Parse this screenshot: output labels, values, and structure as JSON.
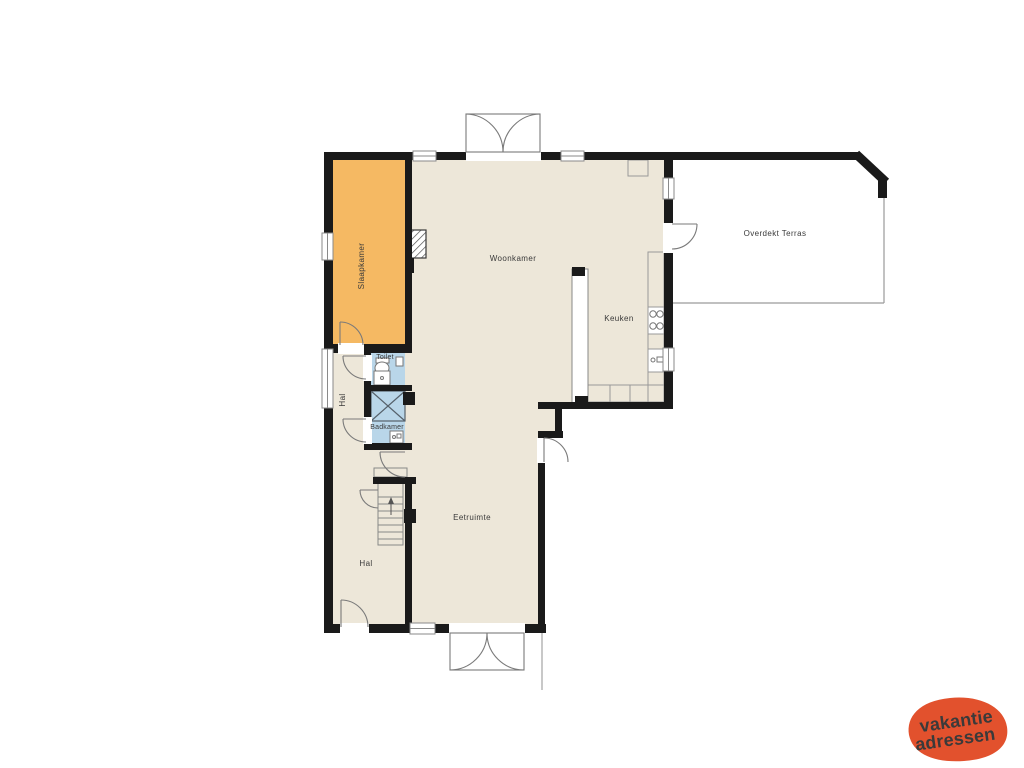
{
  "floorplan": {
    "labels": {
      "slaapkamer": "Slaapkamer",
      "woonkamer": "Woonkamer",
      "keuken": "Keuken",
      "toilet": "Toilet",
      "badkamer": "Badkamer",
      "hal_boven": "Hal",
      "hal_beneden": "Hal",
      "eetruimte": "Eetruimte",
      "terras": "Overdekt Terras"
    },
    "colors": {
      "wall": "#1a1a1a",
      "floor": "#ede7d9",
      "slaapkamer": "#f5b963",
      "sanitair": "#b9d6e9",
      "line": "#7a7a7a",
      "label": "#3a3a3a"
    }
  },
  "logo": {
    "line1": "vakantie",
    "line2": "adressen",
    "bg": "#e2512d",
    "text": "#ffffff"
  }
}
